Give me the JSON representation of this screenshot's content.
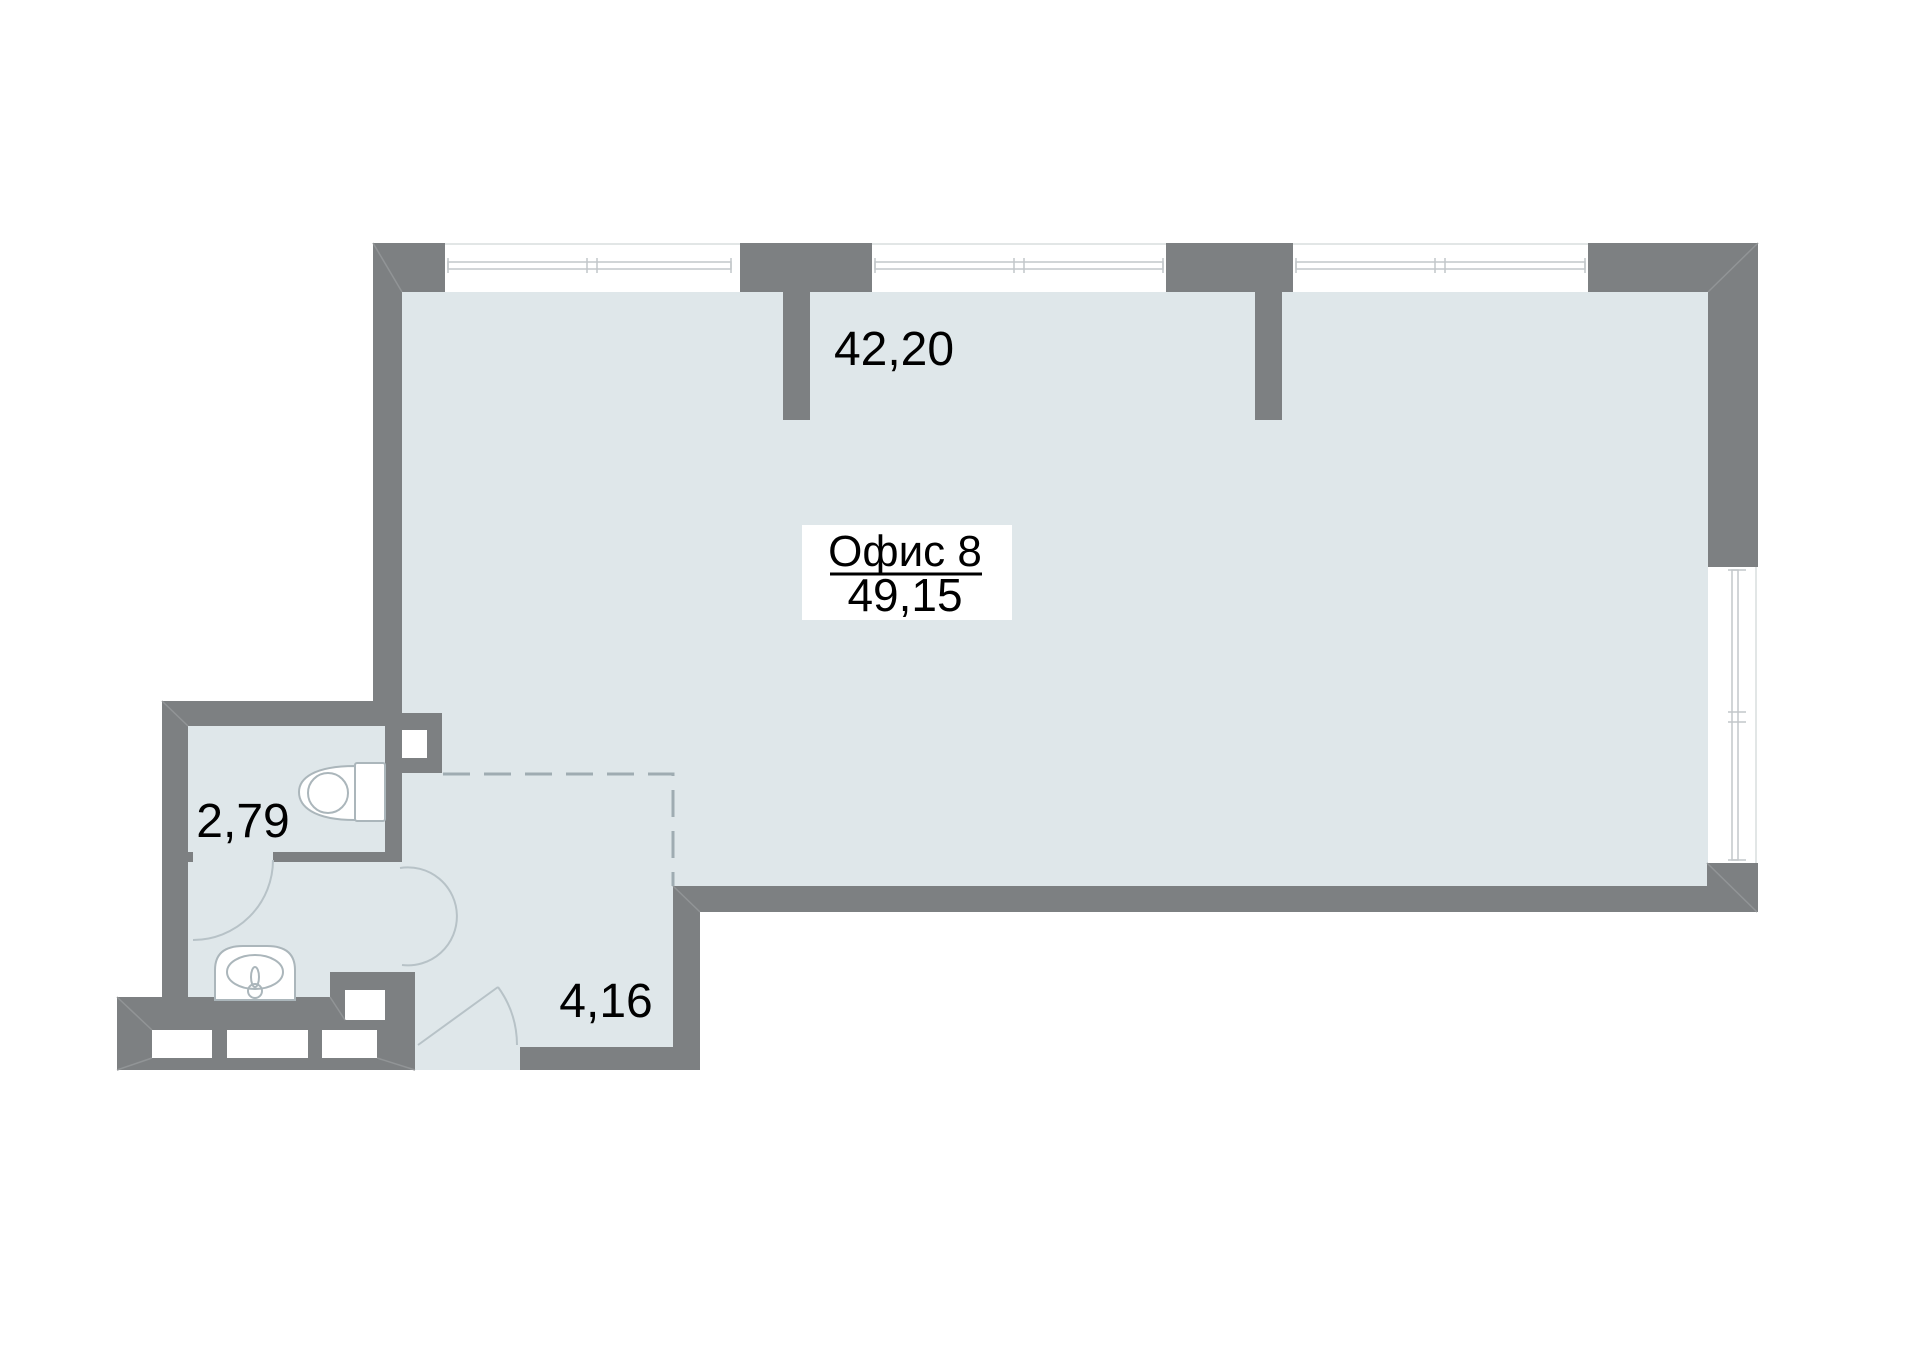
{
  "plan": {
    "office_label": "Офис 8",
    "office_area": "49,15",
    "main_room_area": "42,20",
    "bathroom_area": "2,79",
    "hall_area": "4,16"
  },
  "colors": {
    "background": "#FFFFFF",
    "wall": "#7D8082",
    "floor": "#DFE7EA",
    "label_box": "#FFFFFF",
    "opening_white": "#FFFFFF",
    "miter_line": "#919496",
    "window_frame": "#C2C7CA",
    "window_edge": "#D9DDDE",
    "fixture_stroke": "#ABB6BB",
    "arc_stroke": "#B7C2C7",
    "dashed_line": "#9FACB2",
    "text": "#000000"
  }
}
